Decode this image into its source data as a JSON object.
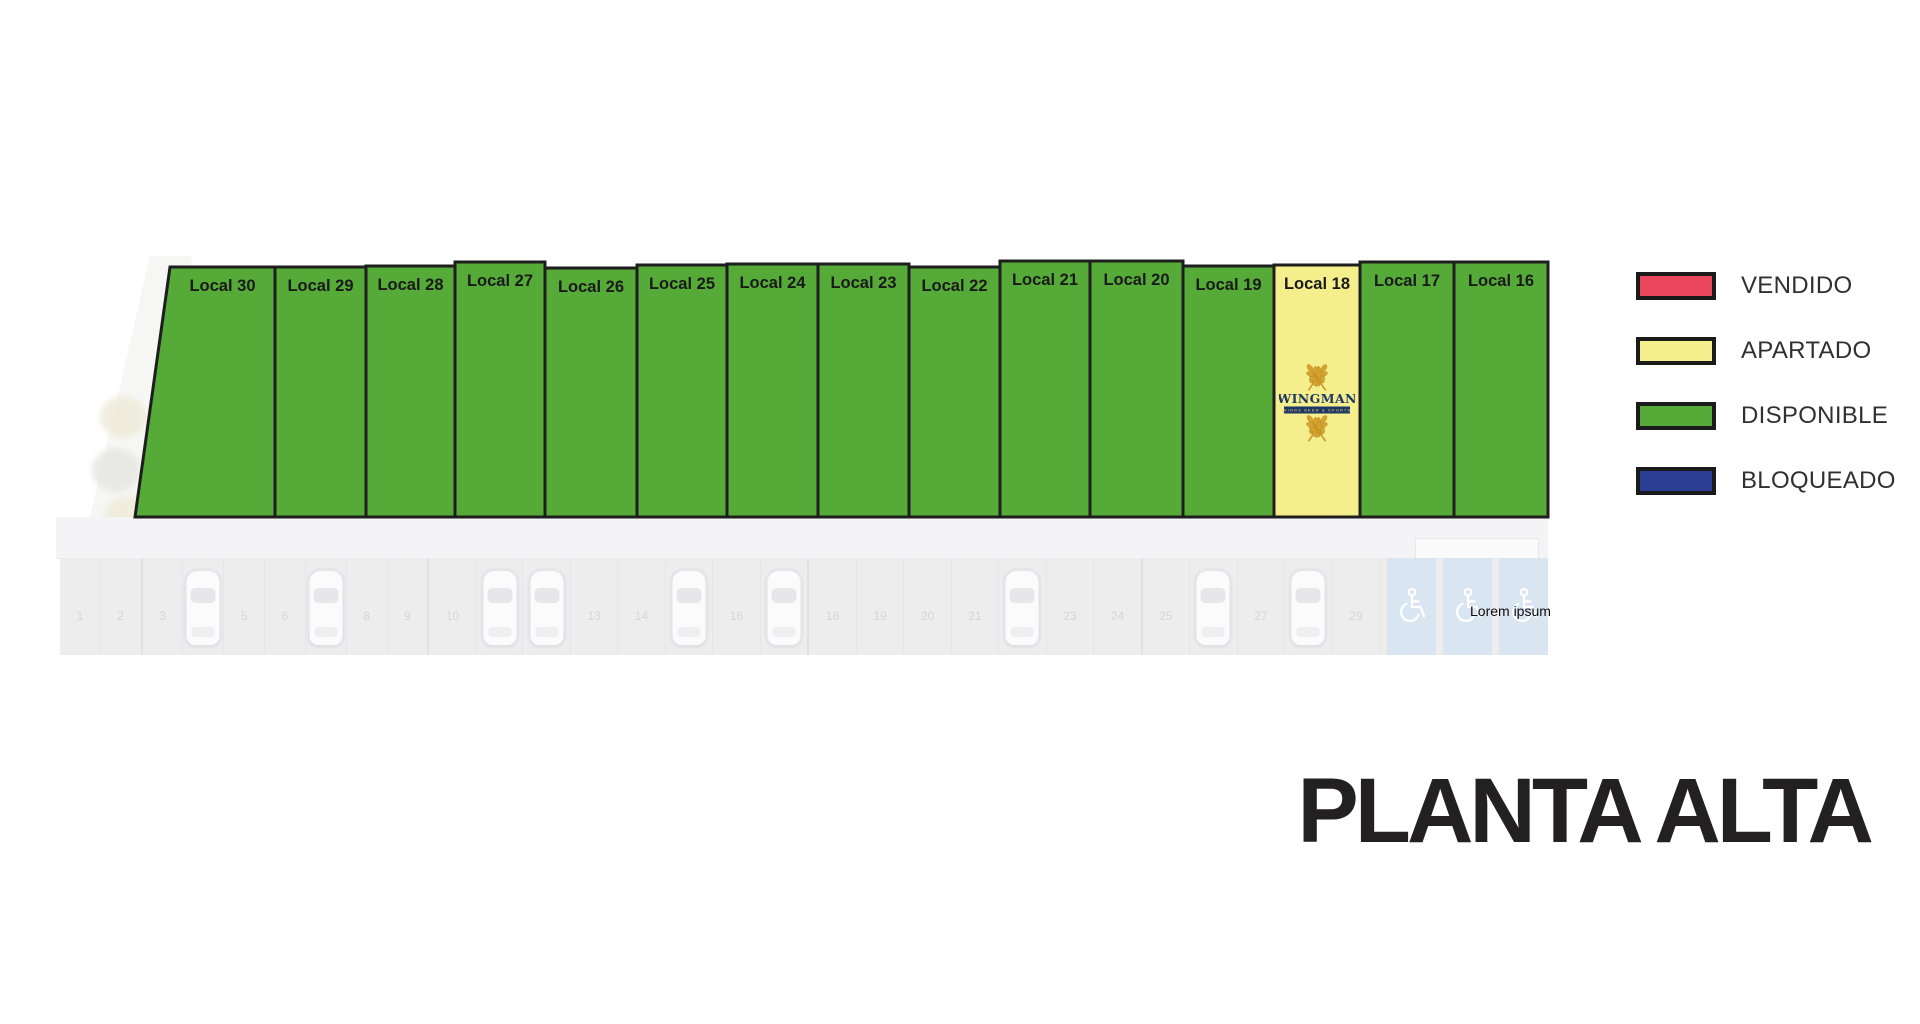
{
  "page": {
    "title_label": "PLANTA ALTA"
  },
  "legend": {
    "items": [
      {
        "status": "vendido",
        "label": "VENDIDO",
        "color": "#E9455C"
      },
      {
        "status": "apartado",
        "label": "APARTADO",
        "color": "#F5EE8C"
      },
      {
        "status": "disponible",
        "label": "DISPONIBLE",
        "color": "#55AA38"
      },
      {
        "status": "bloqueado",
        "label": "BLOQUEADO",
        "color": "#2B3E94"
      }
    ]
  },
  "plan": {
    "locals": [
      {
        "id": 30,
        "label": "Local 30",
        "status": "disponible"
      },
      {
        "id": 29,
        "label": "Local 29",
        "status": "disponible"
      },
      {
        "id": 28,
        "label": "Local 28",
        "status": "disponible"
      },
      {
        "id": 27,
        "label": "Local 27",
        "status": "disponible"
      },
      {
        "id": 26,
        "label": "Local 26",
        "status": "disponible"
      },
      {
        "id": 25,
        "label": "Local 25",
        "status": "disponible"
      },
      {
        "id": 24,
        "label": "Local 24",
        "status": "disponible"
      },
      {
        "id": 23,
        "label": "Local 23",
        "status": "disponible"
      },
      {
        "id": 22,
        "label": "Local 22",
        "status": "disponible"
      },
      {
        "id": 21,
        "label": "Local 21",
        "status": "disponible"
      },
      {
        "id": 20,
        "label": "Local 20",
        "status": "disponible"
      },
      {
        "id": 19,
        "label": "Local 19",
        "status": "disponible"
      },
      {
        "id": 18,
        "label": "Local 18",
        "status": "apartado",
        "tenant": "WINGMAN"
      },
      {
        "id": 17,
        "label": "Local 17",
        "status": "disponible"
      },
      {
        "id": 16,
        "label": "Local 16",
        "status": "disponible"
      }
    ]
  },
  "tenant_logo": {
    "name": "WINGMAN",
    "tagline": "WINGS BEER & SPORTS"
  },
  "parking": {
    "note": "Lorem ipsum",
    "stall_numbers": [
      1,
      2,
      3,
      4,
      5,
      6,
      7,
      8,
      9,
      10,
      11,
      12,
      13,
      14,
      15,
      16,
      17,
      18,
      19,
      20,
      21,
      22,
      23,
      24,
      25,
      26,
      27,
      28,
      29
    ],
    "accessible_stalls": 3,
    "occupied_stalls": [
      4,
      7,
      11,
      12,
      15,
      17,
      22,
      26,
      28
    ]
  }
}
